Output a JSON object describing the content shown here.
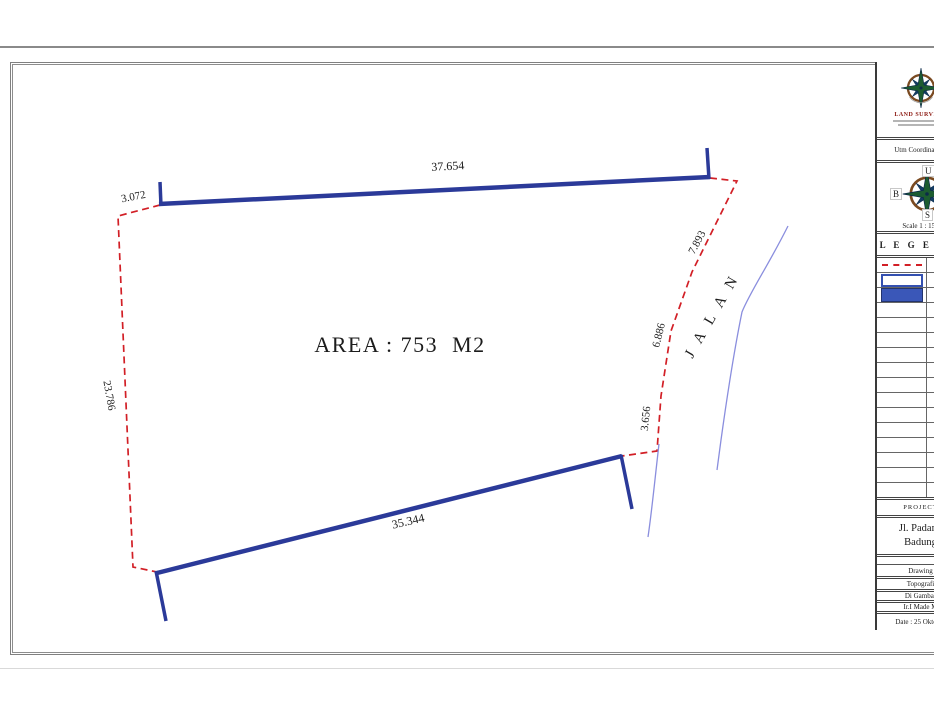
{
  "drawing": {
    "area_label": "AREA : 753  M2",
    "road_label": "J A L A N",
    "dimensions": {
      "top": "37.654",
      "top_left": "3.072",
      "left": "23.786",
      "right_upper": "7.893",
      "right_middle": "6.886",
      "right_lower": "3.656",
      "bottom": "35.344"
    },
    "colors": {
      "boundary_dashed": "#d21f26",
      "boundary_solid": "#2b3a99",
      "road_line": "#8a8ede",
      "label_text": "#1c1c1c"
    }
  },
  "title_block": {
    "logo": {
      "org_name": "LAND SURVEYS"
    },
    "utm_row": "Utm Coordinate &",
    "compass": {
      "north": "U",
      "west": "B",
      "south": "S",
      "east": "T",
      "scale": "Scale 1 : 150"
    },
    "legend": {
      "header": "L E G E N D",
      "empty_row_count": 13
    },
    "project": {
      "header": "PROJECT",
      "address_line1": "Jl. Padang",
      "address_line2": "Badung",
      "rows": [
        "Drawing",
        "Topografi",
        "Di Gambar",
        "Ir.I Made M",
        "Date : 25 Oktober"
      ]
    }
  }
}
